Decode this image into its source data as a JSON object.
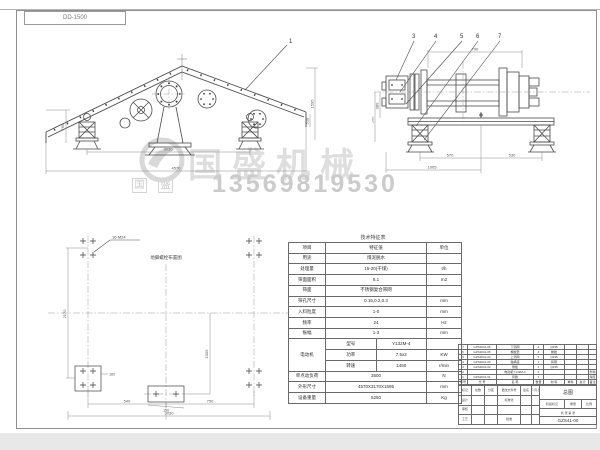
{
  "sheet": {
    "code": "DD-1500"
  },
  "watermark": {
    "brand": "国盛机械",
    "phone": "13569819530",
    "stamp1": "国",
    "stamp2": "盛",
    "color": "#dedede"
  },
  "main_view": {
    "balloon": "1",
    "dim_span": "3030",
    "dim_overall": "4570",
    "dim_left": "765",
    "dim_right": "1595",
    "dim_right2": "518"
  },
  "end_view": {
    "balloons": [
      "3",
      "4",
      "5",
      "6",
      "7"
    ],
    "dim_top": "790",
    "dim_b1": "570",
    "dim_b2": "530",
    "dim_b3": "1005",
    "dim_l1": "380",
    "dim_l2": "500"
  },
  "plan_view": {
    "title": "地脚螺栓布置图",
    "note": "16-M24",
    "dim_left": "2170",
    "dim_b1": "540",
    "dim_b2": "750",
    "dim_b3": "3030",
    "dim_inner": "1005",
    "dim_c": "150",
    "dim_cl": "180"
  },
  "spec_table": {
    "title": "技术特征表",
    "headers": [
      "项目",
      "特征值",
      "单位"
    ],
    "rows": [
      {
        "item": "用途",
        "value": "煤泥脱水",
        "unit": ""
      },
      {
        "item": "处理量",
        "value": "15-20(干煤)",
        "unit": "t/h"
      },
      {
        "item": "筛面面积",
        "value": "8.1",
        "unit": "m2"
      },
      {
        "item": "筛面",
        "value": "不锈钢复合筛网",
        "unit": ""
      },
      {
        "item": "筛孔尺寸",
        "value": "0.15,0.2,0.3",
        "unit": "mm"
      },
      {
        "item": "入料粒度",
        "value": "1-0",
        "unit": "mm"
      },
      {
        "item": "频率",
        "value": "24",
        "unit": "Hz"
      },
      {
        "item": "振幅",
        "value": "1-3",
        "unit": "mm"
      }
    ],
    "motor": {
      "label": "电动机",
      "sub_rows": [
        {
          "item": "型号",
          "value": "Y132M-4",
          "unit": ""
        },
        {
          "item": "功率",
          "value": "7.5x2",
          "unit": "KW"
        },
        {
          "item": "转速",
          "value": "1450",
          "unit": "r/min"
        }
      ]
    },
    "tail_rows": [
      {
        "item": "单点动负荷",
        "value": "3500",
        "unit": "N"
      },
      {
        "item": "外形尺寸",
        "value": "4570X3170X1595",
        "unit": "mm"
      },
      {
        "item": "设备重量",
        "value": "5250",
        "unit": "Kg"
      }
    ]
  },
  "bom": {
    "headers": [
      "序号",
      "代 号",
      "名 称",
      "数量",
      "材 料",
      "单件",
      "总计",
      "备注"
    ],
    "rows": [
      [
        "7",
        "GZS2041-06",
        "下筛网",
        "4",
        "Q235",
        "",
        "",
        ""
      ],
      [
        "6",
        "GZS2041-05",
        "橡胶垫",
        "4",
        "橡胶",
        "",
        "",
        ""
      ],
      [
        "5",
        "GZS2041-04",
        "上筛网",
        "4",
        "Q235",
        "",
        "",
        ""
      ],
      [
        "4",
        "GZS2041-03",
        "轴承座",
        "2",
        "铸钢",
        "",
        "",
        ""
      ],
      [
        "3",
        "GZS2041-02",
        "侧板",
        "1",
        "Q235",
        "",
        "",
        ""
      ],
      [
        "2",
        "",
        "电动机Y132M-4",
        "2",
        "",
        "",
        "",
        "外购"
      ],
      [
        "1",
        "GZS2041-01",
        "筛箱",
        "1",
        "",
        "",
        "",
        "焊接"
      ]
    ]
  },
  "title_block": {
    "r1": [
      "标记",
      "处数",
      "分区",
      "更改文件号",
      "签名",
      "年.月.日"
    ],
    "r2": [
      "设计",
      "",
      "",
      "标准化",
      "",
      ""
    ],
    "r3": [
      "审核",
      "",
      "",
      "",
      "",
      ""
    ],
    "r4": [
      "工艺",
      "",
      "",
      "批准",
      "",
      ""
    ],
    "stage": "阶段标记",
    "weight": "重量",
    "scale": "比例",
    "sheets": "共 张 第 张",
    "name": "总图",
    "number": "GZS41-00"
  }
}
